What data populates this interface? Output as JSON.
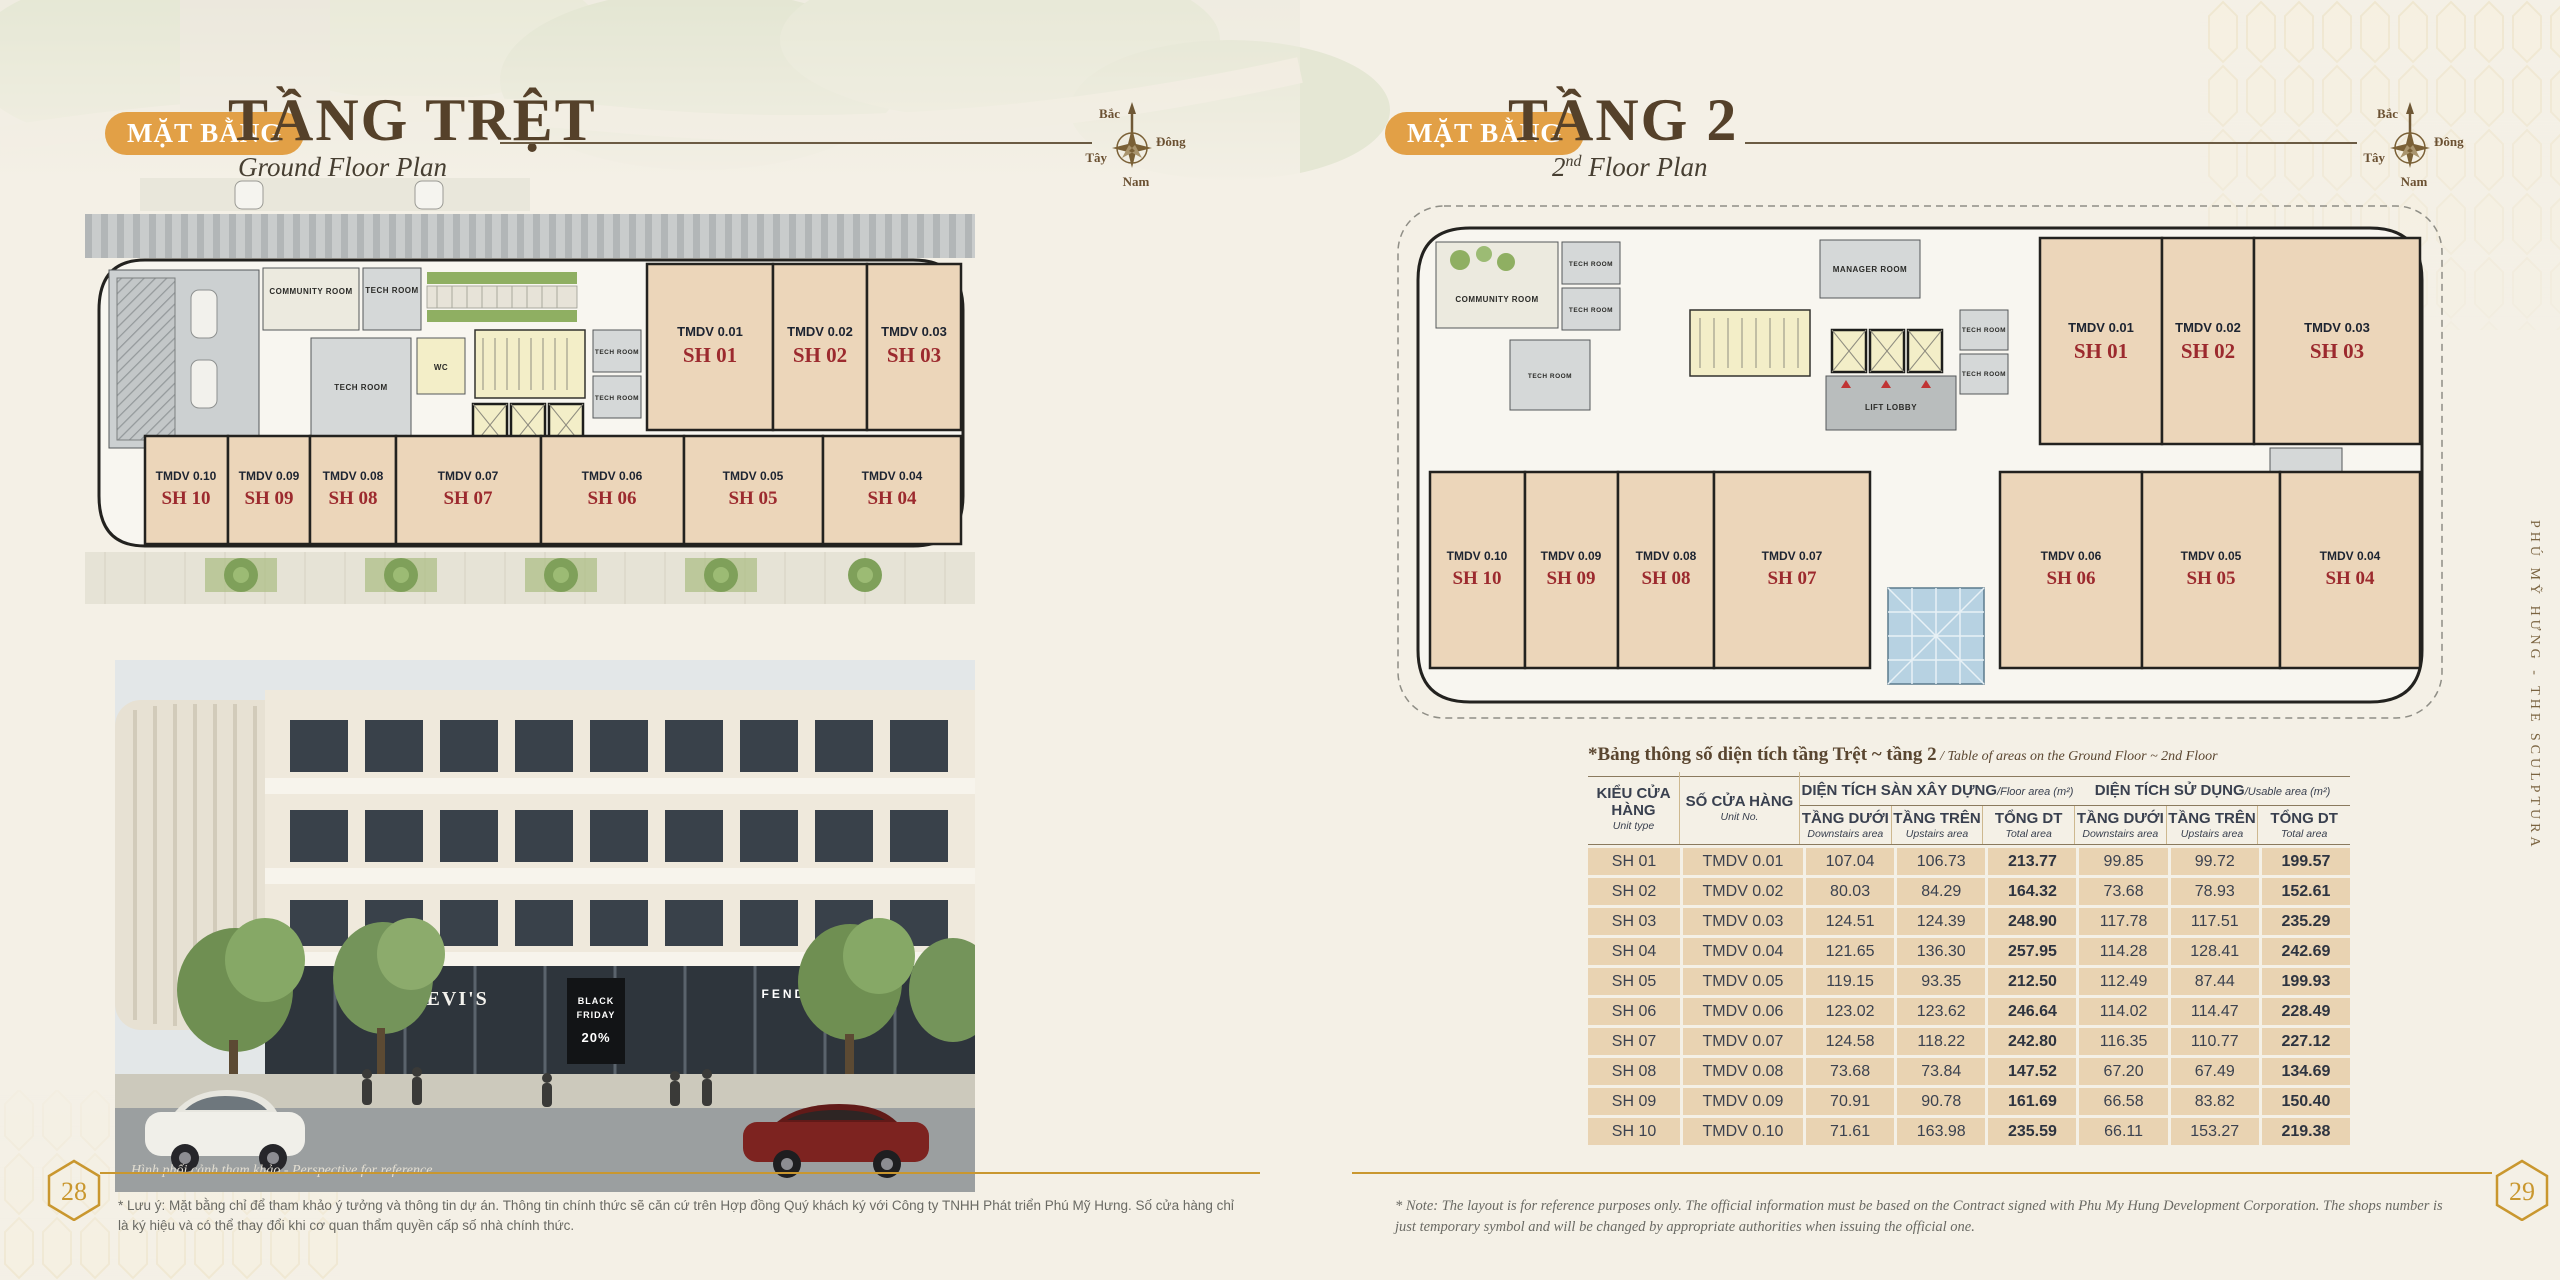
{
  "page": {
    "left_number": "28",
    "right_number": "29",
    "side_text": "PHÚ MỸ HƯNG  -  THE SCULPTURA"
  },
  "left_header": {
    "badge": "MẶT BẰNG",
    "title": "TẦNG TRỆT",
    "subtitle": "Ground Floor Plan"
  },
  "right_header": {
    "badge": "MẶT BẰNG",
    "title": "TẦNG 2",
    "subtitle_num": "2",
    "subtitle_sup": "nd",
    "subtitle_rest": " Floor Plan"
  },
  "compass": {
    "north": "Bắc",
    "east": "Đông",
    "west": "Tây",
    "south": "Nam"
  },
  "rooms": {
    "community": "COMMUNITY ROOM",
    "tech": "TECH ROOM",
    "wc": "WC",
    "lift_lobby": "LIFT LOBBY",
    "manager": "MANAGER ROOM"
  },
  "units": {
    "top": [
      {
        "no": "TMDV 0.01",
        "sh": "SH 01"
      },
      {
        "no": "TMDV 0.02",
        "sh": "SH 02"
      },
      {
        "no": "TMDV 0.03",
        "sh": "SH 03"
      }
    ],
    "bottom": [
      {
        "no": "TMDV 0.10",
        "sh": "SH 10"
      },
      {
        "no": "TMDV 0.09",
        "sh": "SH 09"
      },
      {
        "no": "TMDV 0.08",
        "sh": "SH 08"
      },
      {
        "no": "TMDV 0.07",
        "sh": "SH 07"
      },
      {
        "no": "TMDV 0.06",
        "sh": "SH 06"
      },
      {
        "no": "TMDV 0.05",
        "sh": "SH 05"
      },
      {
        "no": "TMDV 0.04",
        "sh": "SH 04"
      }
    ]
  },
  "photo": {
    "caption": "Hình phối cảnh tham khảo - Perspective for reference",
    "sign_levis": "LEVI'S",
    "sign_black": "BLACK",
    "sign_friday": "FRIDAY",
    "sign_pct": "20%",
    "sign_fendi": "FENDI"
  },
  "table": {
    "caption_vi": "*Bảng thông số diện tích tầng Trệt ~ tầng 2",
    "caption_en": " / Table of areas on the Ground Floor ~ 2nd Floor",
    "col1": {
      "vi": "KIỂU CỬA HÀNG",
      "en": "Unit type"
    },
    "col2": {
      "vi": "SỐ CỬA HÀNG",
      "en": "Unit No."
    },
    "group1": {
      "vi": "DIỆN TÍCH SÀN XÂY DỰNG",
      "en": "/Floor area (m²)"
    },
    "group2": {
      "vi": "DIỆN TÍCH SỬ DỤNG",
      "en": "/Usable area (m²)"
    },
    "sub": [
      {
        "vi": "TẦNG DƯỚI",
        "en": "Downstairs area"
      },
      {
        "vi": "TẦNG TRÊN",
        "en": "Upstairs area"
      },
      {
        "vi": "TỔNG DT",
        "en": "Total area"
      },
      {
        "vi": "TẦNG DƯỚI",
        "en": "Downstairs area"
      },
      {
        "vi": "TẦNG TRÊN",
        "en": "Upstairs area"
      },
      {
        "vi": "TỔNG DT",
        "en": "Total area"
      }
    ],
    "rows": [
      [
        "SH 01",
        "TMDV 0.01",
        "107.04",
        "106.73",
        "213.77",
        "99.85",
        "99.72",
        "199.57"
      ],
      [
        "SH 02",
        "TMDV 0.02",
        "80.03",
        "84.29",
        "164.32",
        "73.68",
        "78.93",
        "152.61"
      ],
      [
        "SH 03",
        "TMDV 0.03",
        "124.51",
        "124.39",
        "248.90",
        "117.78",
        "117.51",
        "235.29"
      ],
      [
        "SH 04",
        "TMDV 0.04",
        "121.65",
        "136.30",
        "257.95",
        "114.28",
        "128.41",
        "242.69"
      ],
      [
        "SH 05",
        "TMDV 0.05",
        "119.15",
        "93.35",
        "212.50",
        "112.49",
        "87.44",
        "199.93"
      ],
      [
        "SH 06",
        "TMDV 0.06",
        "123.02",
        "123.62",
        "246.64",
        "114.02",
        "114.47",
        "228.49"
      ],
      [
        "SH 07",
        "TMDV 0.07",
        "124.58",
        "118.22",
        "242.80",
        "116.35",
        "110.77",
        "227.12"
      ],
      [
        "SH 08",
        "TMDV 0.08",
        "73.68",
        "73.84",
        "147.52",
        "67.20",
        "67.49",
        "134.69"
      ],
      [
        "SH 09",
        "TMDV 0.09",
        "70.91",
        "90.78",
        "161.69",
        "66.58",
        "83.82",
        "150.40"
      ],
      [
        "SH 10",
        "TMDV 0.10",
        "71.61",
        "163.98",
        "235.59",
        "66.11",
        "153.27",
        "219.38"
      ]
    ]
  },
  "footnotes": {
    "left": "* Lưu ý: Mặt bằng chỉ để tham khảo ý tưởng và thông tin dự án. Thông tin chính thức sẽ căn cứ trên Hợp đồng Quý khách ký với Công ty TNHH Phát triển Phú Mỹ Hưng. Số cửa hàng chỉ là ký hiệu và có thể thay đổi khi cơ quan thẩm quyền cấp số nhà chính thức.",
    "right": "* Note: The layout is for reference purposes only. The official information must be based on the Contract signed with Phu My Hung Development Corporation. The shops number is just temporary symbol and will be changed by appropriate authorities when issuing the official one."
  },
  "colors": {
    "accent_gold": "#C9972F",
    "badge_orange": "#E2A046",
    "title_brown": "#55412A",
    "unit_red": "#9C2A2E",
    "unit_beige": "#ECD6BA",
    "table_tan": "#E9D3B2",
    "header_dark": "#39404F"
  }
}
